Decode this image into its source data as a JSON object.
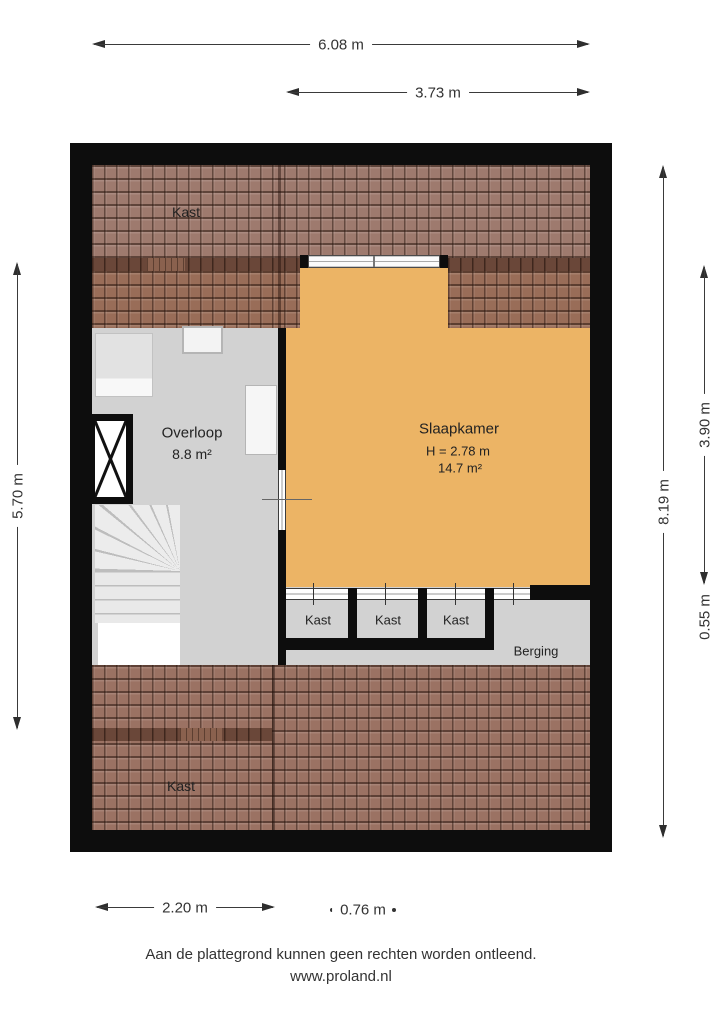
{
  "dimensions": {
    "top_outer": "6.08 m",
    "top_inner": "3.73 m",
    "left": "5.70 m",
    "right_outer": "8.19 m",
    "right_mid": "3.90 m",
    "right_lower": "0.55 m",
    "bottom_left": "2.20 m",
    "bottom_right": "0.76 m"
  },
  "rooms": {
    "kast_top": "Kast",
    "overloop": {
      "name": "Overloop",
      "area": "8.8 m²"
    },
    "slaapkamer": {
      "name": "Slaapkamer",
      "height": "H = 2.78 m",
      "area": "14.7 m²"
    },
    "closets": [
      "Kast",
      "Kast",
      "Kast"
    ],
    "berging": "Berging",
    "kast_bottom": "Kast"
  },
  "footer": {
    "disclaimer": "Aan de plattegrond kunnen geen rechten worden ontleend.",
    "website": "www.proland.nl"
  },
  "colors": {
    "wall": "#0d0d0d",
    "floor_gray": "#d2d2d2",
    "room_orange": "#ecb465",
    "tile_brown": "#9b7263",
    "knee_wall_band": "#6a4739"
  }
}
